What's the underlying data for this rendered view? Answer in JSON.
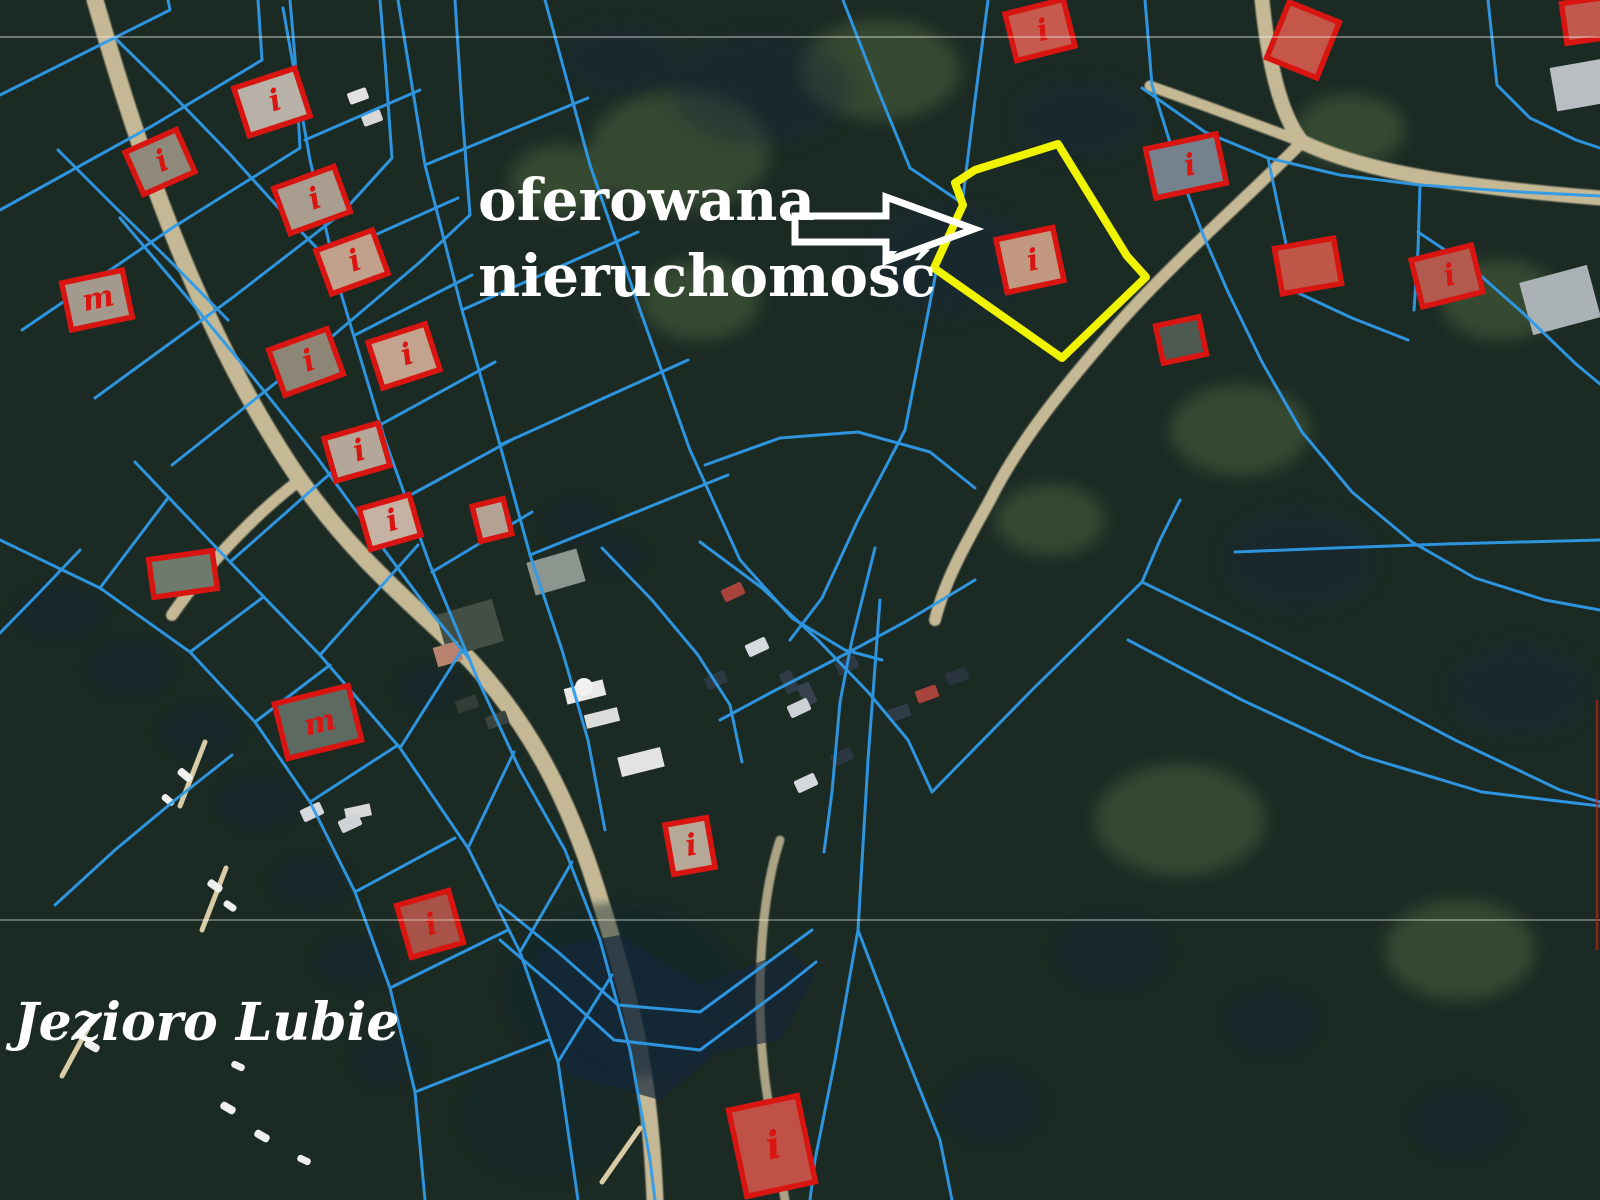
{
  "map": {
    "annotation": {
      "line1": "oferowana",
      "line2": "nieruchomość"
    },
    "lake_label": "Jezioro Lubie",
    "building_marks": {
      "i": "i",
      "m": "m"
    },
    "colors": {
      "parcel_line": "#2f9ae8",
      "building_outline": "#d81510",
      "highlight_outline": "#f0f400",
      "arrow": "#ffffff",
      "label_text": "#ffffff"
    }
  }
}
